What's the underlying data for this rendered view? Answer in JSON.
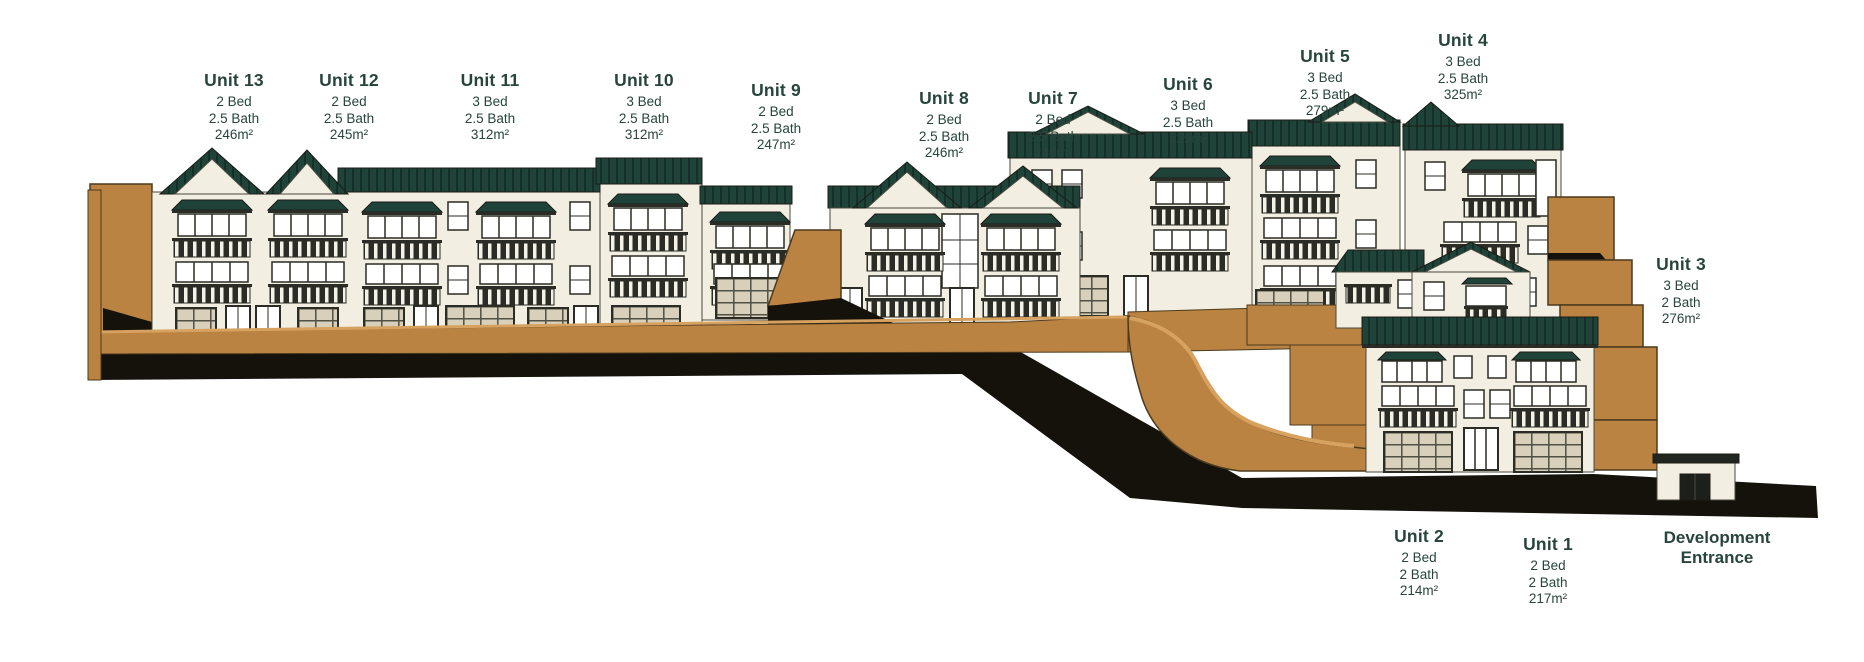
{
  "page_title": "Hillside development cross-section elevation",
  "units": {
    "u13": {
      "title": "Unit 13",
      "bed": "2 Bed",
      "bath": "2.5 Bath",
      "area": "246m²"
    },
    "u12": {
      "title": "Unit 12",
      "bed": "2 Bed",
      "bath": "2.5 Bath",
      "area": "245m²"
    },
    "u11": {
      "title": "Unit 11",
      "bed": "3 Bed",
      "bath": "2.5 Bath",
      "area": "312m²"
    },
    "u10": {
      "title": "Unit 10",
      "bed": "3 Bed",
      "bath": "2.5 Bath",
      "area": "312m²"
    },
    "u9": {
      "title": "Unit 9",
      "bed": "2 Bed",
      "bath": "2.5 Bath",
      "area": "247m²"
    },
    "u8": {
      "title": "Unit 8",
      "bed": "2 Bed",
      "bath": "2.5 Bath",
      "area": "246m²"
    },
    "u7": {
      "title": "Unit 7",
      "bed": "2 Bed",
      "bath": "2.5 Bath",
      "area": "246m²"
    },
    "u6": {
      "title": "Unit 6",
      "bed": "3 Bed",
      "bath": "2.5 Bath",
      "area": "329m²"
    },
    "u5": {
      "title": "Unit 5",
      "bed": "3 Bed",
      "bath": "2.5 Bath",
      "area": "279m²"
    },
    "u4": {
      "title": "Unit 4",
      "bed": "3 Bed",
      "bath": "2.5 Bath",
      "area": "325m²"
    },
    "u3": {
      "title": "Unit 3",
      "bed": "3 Bed",
      "bath": "2 Bath",
      "area": "276m²"
    },
    "u2": {
      "title": "Unit 2",
      "bed": "2 Bed",
      "bath": "2 Bath",
      "area": "214m²"
    },
    "u1": {
      "title": "Unit 1",
      "bed": "2 Bed",
      "bath": "2 Bath",
      "area": "217m²"
    }
  },
  "entrance": {
    "line1": "Development",
    "line2": "Entrance"
  },
  "colors": {
    "label_text": "#27443d",
    "roof_green": "#1f4339",
    "wall_cream": "#f2eee1",
    "earth_tan": "#bb8342",
    "earth_light": "#d7a160",
    "section_black": "#15120b",
    "frame_dark": "#2b2c25"
  }
}
